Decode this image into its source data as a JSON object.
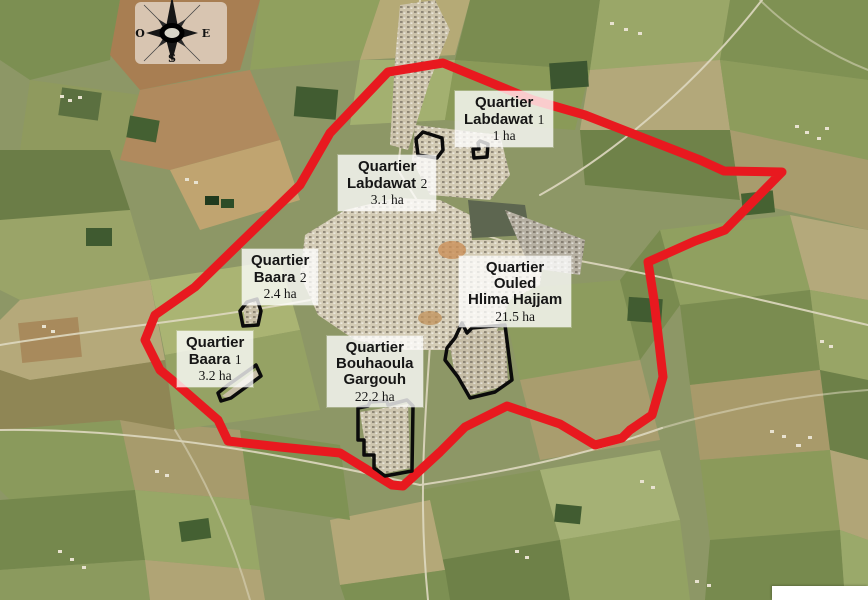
{
  "figure": {
    "type": "annotated satellite map of town quarters",
    "boundary_color": "#e8191f",
    "district_outline_color": "#0b0b0b"
  },
  "compass": {
    "west_label": "O",
    "east_label": "E",
    "south_label": "S"
  },
  "quarters": {
    "labdawat1": {
      "title": "Quartier",
      "name": "Labdawat",
      "num": "1",
      "area": "1 ha"
    },
    "labdawat2": {
      "title": "Quartier",
      "name": "Labdawat",
      "num": "2",
      "area": "3.1 ha"
    },
    "baara2": {
      "title": "Quartier",
      "name": "Baara",
      "num": "2",
      "area": "2.4 ha"
    },
    "baara1": {
      "title": "Quartier",
      "name": "Baara",
      "num": "1",
      "area": "3.2 ha"
    },
    "ouled_hlima_hajjam": {
      "title": "Quartier",
      "line2": "Ouled",
      "line3": "Hlima Hajjam",
      "area": "21.5 ha"
    },
    "bouhaoula_gargouh": {
      "title": "Quartier",
      "line2": "Bouhaoula",
      "line3": "Gargouh",
      "area": "22.2 ha"
    }
  }
}
